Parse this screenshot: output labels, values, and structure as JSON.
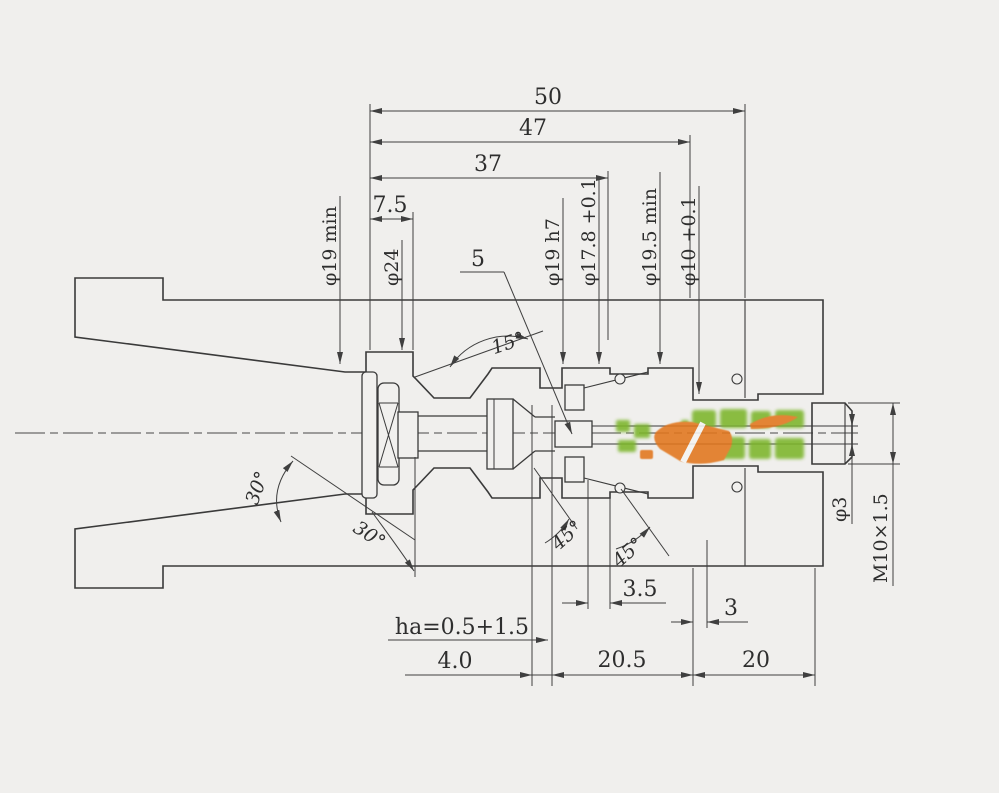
{
  "drawing": {
    "top_dims": {
      "d50": "50",
      "d47": "47",
      "d37": "37",
      "d7_5": "7.5"
    },
    "diameter_labels": {
      "dia19min": "φ19 min",
      "dia24": "φ24",
      "part5": "5",
      "dia19h7": "φ19 h7",
      "dia17_8": "φ17.8 +0.1",
      "dia19_5min": "φ19.5 min",
      "dia10_01": "φ10 +0.1"
    },
    "right_labels": {
      "dia3": "φ3",
      "thread": "M10×1.5"
    },
    "bottom_dims": {
      "d3_5": "3.5",
      "d3": "3",
      "ha": "ha=0.5+1.5",
      "d4_0": "4.0",
      "d20_5": "20.5",
      "d20": "20"
    },
    "angle_labels": {
      "a15": "15°",
      "a30_upper": "30°",
      "a30_lower": "30°",
      "a45_left": "45°",
      "a45_right": "45°"
    },
    "colors": {
      "background": "#f0efed",
      "line": "#3a3a3a",
      "watermark_orange": "#e2761b",
      "watermark_green": "#7cb52c"
    }
  }
}
